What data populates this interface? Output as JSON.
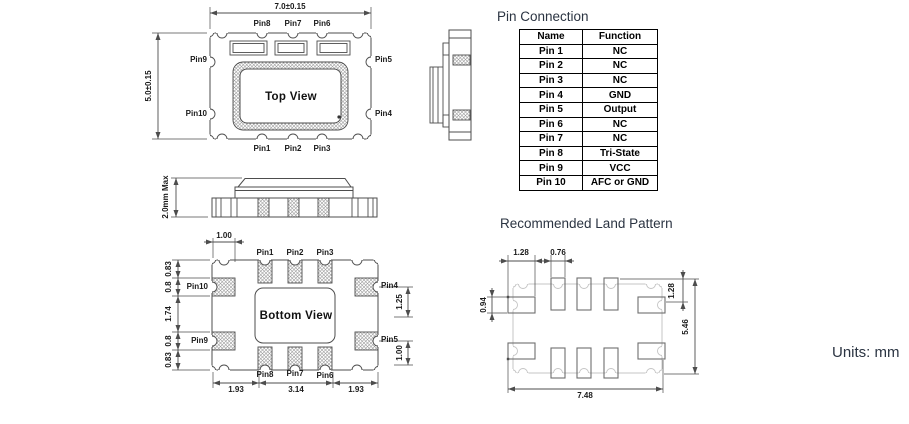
{
  "page": {
    "units_label": "Units: mm"
  },
  "top_view": {
    "label": "Top View",
    "dim_width": "7.0±0.15",
    "dim_height": "5.0±0.15",
    "pins_top": [
      "Pin8",
      "Pin7",
      "Pin6"
    ],
    "pins_bottom": [
      "Pin1",
      "Pin2",
      "Pin3"
    ],
    "pins_left": [
      "Pin9",
      "Pin10"
    ],
    "pins_right": [
      "Pin5",
      "Pin4"
    ]
  },
  "front_view": {
    "dim_height": "2.0mm Max"
  },
  "bottom_view": {
    "label": "Bottom View",
    "dim_top": "1.00",
    "pins_top": [
      "Pin1",
      "Pin2",
      "Pin3"
    ],
    "pins_bottom": [
      "Pin8",
      "Pin7",
      "Pin6"
    ],
    "pins_left": [
      "Pin10",
      "Pin9"
    ],
    "pins_right": [
      "Pin4",
      "Pin5"
    ],
    "dims_left": [
      "0.83",
      "0.8",
      "1.74",
      "0.8",
      "0.83"
    ],
    "dims_right": [
      "1.25",
      "1.00"
    ],
    "dims_bottom": [
      "1.93",
      "3.14",
      "1.93"
    ]
  },
  "pin_connection": {
    "title": "Pin Connection",
    "col_name": "Name",
    "col_function": "Function",
    "rows": [
      {
        "name": "Pin 1",
        "func": "NC"
      },
      {
        "name": "Pin 2",
        "func": "NC"
      },
      {
        "name": "Pin 3",
        "func": "NC"
      },
      {
        "name": "Pin 4",
        "func": "GND"
      },
      {
        "name": "Pin 5",
        "func": "Output"
      },
      {
        "name": "Pin 6",
        "func": "NC"
      },
      {
        "name": "Pin 7",
        "func": "NC"
      },
      {
        "name": "Pin 8",
        "func": "Tri-State"
      },
      {
        "name": "Pin 9",
        "func": "VCC"
      },
      {
        "name": "Pin 10",
        "func": "AFC or GND"
      }
    ]
  },
  "land_pattern": {
    "title": "Recommended Land Pattern",
    "dim_pad_width": "1.28",
    "dim_small_pad_width": "0.76",
    "dim_pad_height": "0.94",
    "dim_top_offset": "1.28",
    "dim_overall_height": "5.46",
    "dim_overall_width": "7.48"
  }
}
